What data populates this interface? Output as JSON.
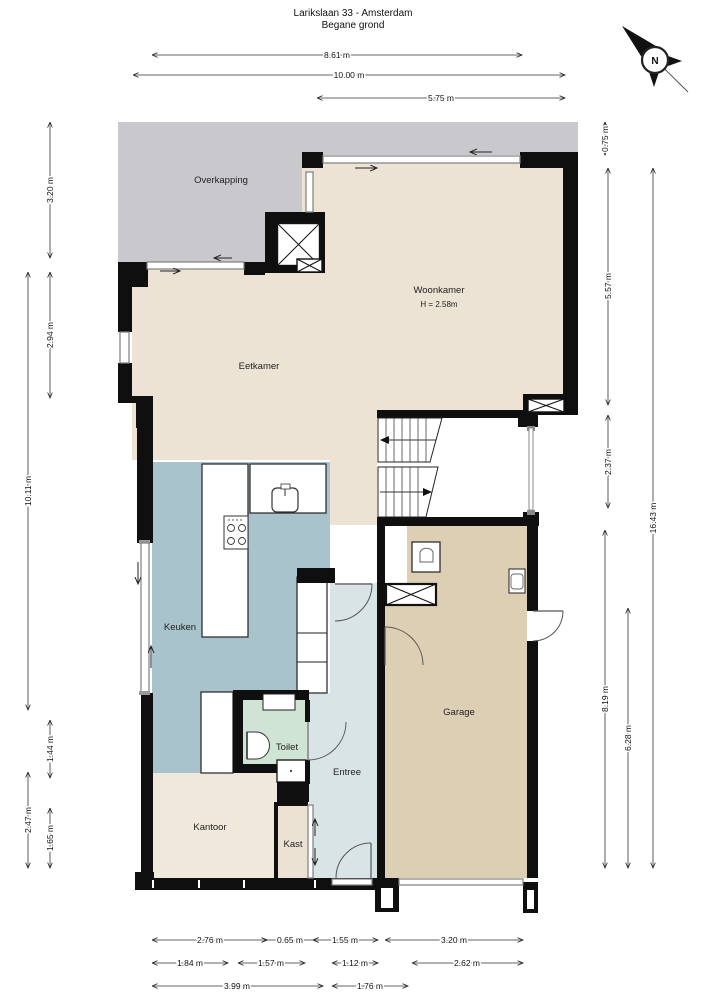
{
  "title": {
    "line1": "Larikslaan 33 - Amsterdam",
    "line2": "Begane grond"
  },
  "compass": {
    "label": "N"
  },
  "rooms": {
    "overkapping": {
      "label": "Overkapping"
    },
    "woonkamer": {
      "label": "Woonkamer",
      "height_note": "H = 2.58m"
    },
    "eetkamer": {
      "label": "Eetkamer"
    },
    "keuken": {
      "label": "Keuken"
    },
    "toilet": {
      "label": "Toilet"
    },
    "entree": {
      "label": "Entree"
    },
    "kantoor": {
      "label": "Kantoor"
    },
    "kast": {
      "label": "Kast"
    },
    "garage": {
      "label": "Garage"
    }
  },
  "colors": {
    "overkapping": "#c9c9cd",
    "woonkamer": "#ece3d4",
    "eetkamer": "#ece3d4",
    "corridor": "#ece3d4",
    "keuken": "#a9c3cc",
    "entree": "#d9e4e7",
    "toilet": "#cfe4d4",
    "kantoor": "#f0e8da",
    "kast": "#ebe2d3",
    "garage": "#ddcfb4",
    "wall": "#0f0f0f"
  },
  "dimensions": {
    "top": [
      "8.61 m",
      "10.00 m",
      "5.75 m"
    ],
    "left": [
      "3.20 m",
      "2.94 m",
      "10.11 m",
      "1.44 m",
      "2.47 m",
      "1.65 m"
    ],
    "right": [
      "0.75 m",
      "5.57 m",
      "2.37 m",
      "8.19 m",
      "6.28 m",
      "16.43 m"
    ],
    "bottom_row1": [
      "2.76 m",
      "0.65 m",
      "1.55 m",
      "3.20 m"
    ],
    "bottom_row2": [
      "1.84 m",
      "1.57 m",
      "1.12 m",
      "2.62 m"
    ],
    "bottom_row3": [
      "3.99 m",
      "1.76 m"
    ]
  }
}
